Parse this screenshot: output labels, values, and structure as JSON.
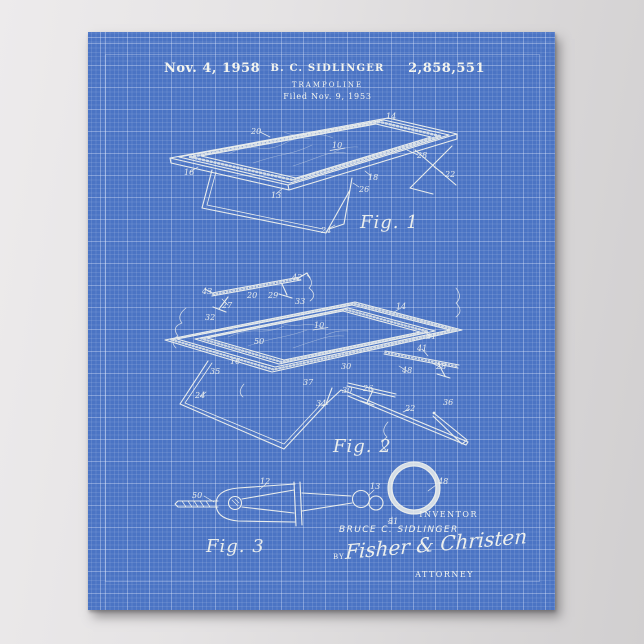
{
  "poster": {
    "colors": {
      "paper_blue": "#4b74c4",
      "grid_line": "#6b8ed3",
      "ink_white": "#f3f4ee",
      "backdrop_gray": "#e0dedf"
    },
    "header": {
      "date": "Nov. 4, 1958",
      "inventor": "B. C. SIDLINGER",
      "patent_number": "2,858,551",
      "title": "TRAMPOLINE",
      "filed": "Filed Nov. 9, 1953"
    },
    "figures": [
      {
        "caption": "Fig. 1",
        "numerals": [
          "20",
          "14",
          "10",
          "28",
          "22",
          "16",
          "18",
          "26",
          "13",
          "24"
        ]
      },
      {
        "caption": "Fig. 2",
        "numerals": [
          "42",
          "43",
          "20",
          "29",
          "27",
          "33",
          "14",
          "32",
          "10",
          "31",
          "50",
          "41",
          "16",
          "30",
          "48",
          "28",
          "35",
          "37",
          "30",
          "26",
          "24",
          "34",
          "22",
          "36"
        ]
      },
      {
        "caption": "Fig. 3",
        "numerals": [
          "50",
          "12",
          "13",
          "51",
          "48"
        ]
      }
    ],
    "footer": {
      "inventor_caption": "INVENTOR",
      "inventor_name": "BRUCE C. SIDLINGER",
      "by_label": "BY",
      "signature": "Fisher & Christen",
      "attorney_caption": "ATTORNEY"
    }
  }
}
